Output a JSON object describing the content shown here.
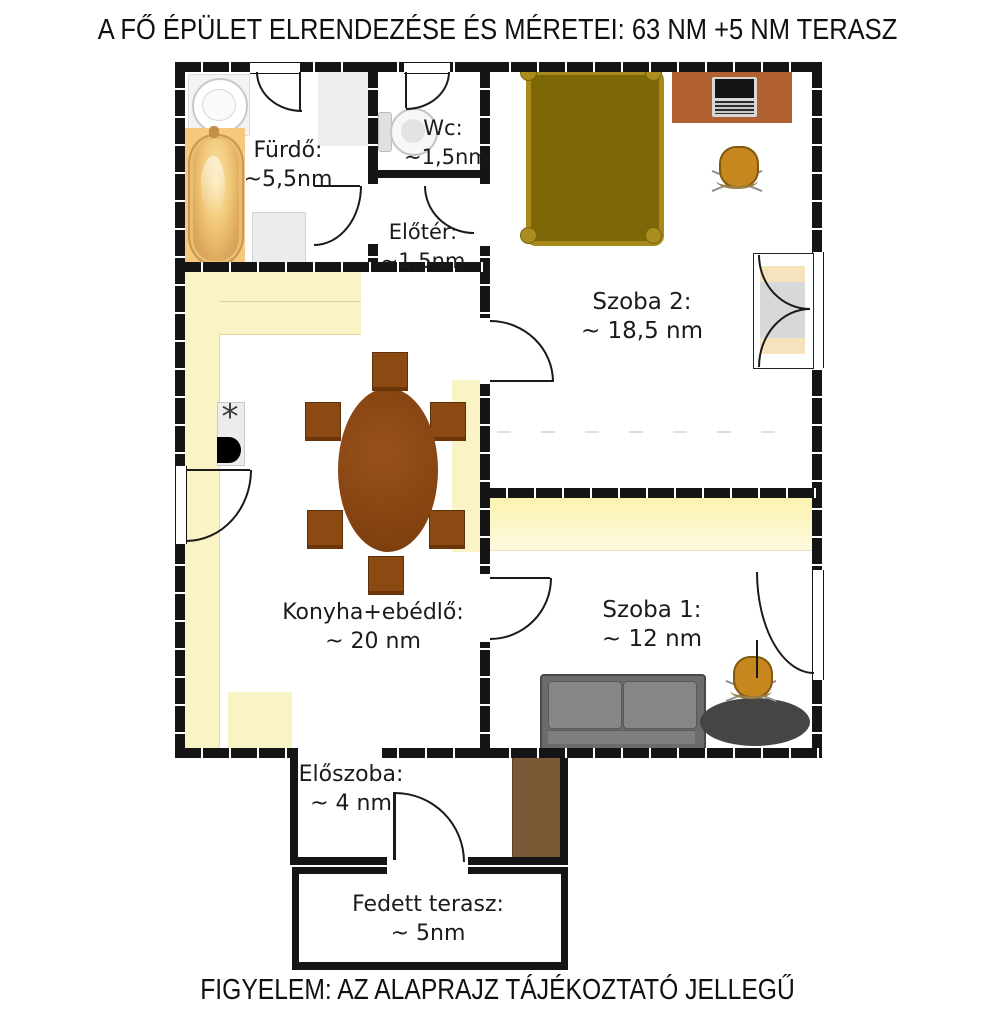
{
  "title": "A FŐ ÉPÜLET ELRENDEZÉSE ÉS MÉRETEI: 63 NM +5 NM TERASZ",
  "footer": "FIGYELEM: AZ ALAPRAJZ TÁJÉKOZTATÓ JELLEGŰ",
  "rooms": {
    "furdo": {
      "name": "Fürdő:",
      "area": "~5,5nm"
    },
    "wc": {
      "name": "Wc:",
      "area": "~1,5nm"
    },
    "eloter": {
      "name": "Előtér:",
      "area": "~1,5nm"
    },
    "szoba2": {
      "name": "Szoba 2:",
      "area": "~ 18,5 nm"
    },
    "konyha": {
      "name": "Konyha+ebédlő:",
      "area": "~ 20 nm"
    },
    "szoba1": {
      "name": "Szoba 1:",
      "area": "~ 12 nm"
    },
    "eloszoba": {
      "name": "Előszoba:",
      "area": "~ 4 nm"
    },
    "terasz": {
      "name": "Fedett terasz:",
      "area": "~ 5nm"
    }
  },
  "icons": {
    "stove_burner": "*"
  },
  "colors": {
    "wall": "#151515",
    "counter_cream": "#f9f3c5",
    "wardrobe_yellow": "#fbf2ae",
    "bathtub_panel": "#f6c87e",
    "bed_fill": "#7d6606",
    "bed_frame": "#a8891c",
    "desk_brown": "#b06031",
    "chair_gold": "#c8861e",
    "table_brown": "#8a4a12",
    "sofa_gray": "#6b6b6b",
    "rug_dark": "#454545",
    "hall_wardrobe_brown": "#7b5836"
  }
}
